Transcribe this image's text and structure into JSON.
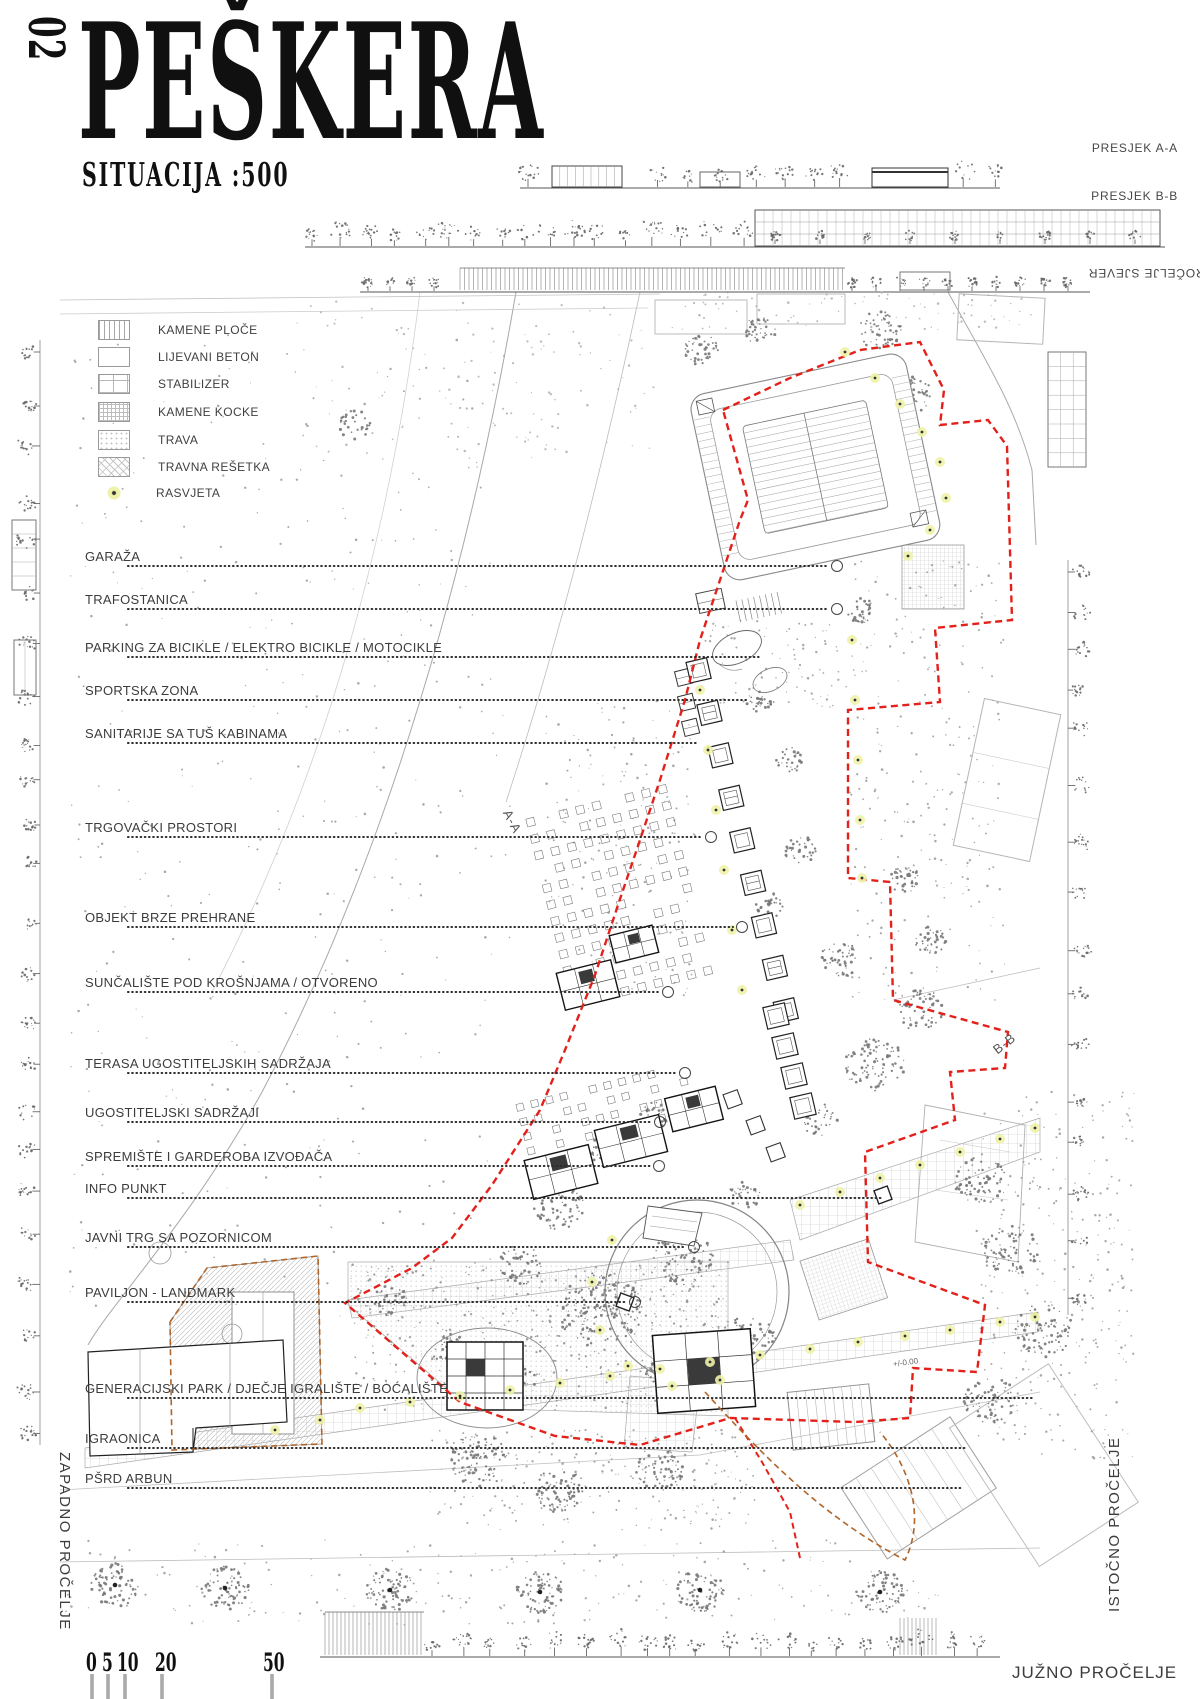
{
  "title_block": {
    "number": "02",
    "title": "PEŠKERA",
    "subtitle": "SITUACIJA :500"
  },
  "section_labels": {
    "presjek_aa": "PRESJEK A-A",
    "presjek_bb": "PRESJEK B-B",
    "procelje_sjever": "PROČELJE SJEVER",
    "juzno_procelje": "JUŽNO PROČELJE",
    "zapadno_procelje": "ZAPADNO PROČELJE",
    "istocno_procelje": "ISTOČNO PROČELJE"
  },
  "section_marks": {
    "aa": "A-A",
    "bb": "B-B"
  },
  "legend": [
    {
      "label": "KAMENE PLOČE",
      "swatch": "vlines"
    },
    {
      "label": "LIJEVANI BETON",
      "swatch": "plain"
    },
    {
      "label": "STABILIZER",
      "swatch": "coarse-grid"
    },
    {
      "label": "KAMENE KOCKE",
      "swatch": "fine-grid"
    },
    {
      "label": "TRAVA",
      "swatch": "dots"
    },
    {
      "label": "TRAVNA REŠETKA",
      "swatch": "diagonal"
    },
    {
      "label": "RASVJETA",
      "swatch": "light"
    }
  ],
  "plan_labels": [
    {
      "label": "GARAŽA",
      "y": 549,
      "to": 828,
      "end": "circle"
    },
    {
      "label": "TRAFOSTANICA",
      "y": 592,
      "to": 828,
      "end": "circle"
    },
    {
      "label": "PARKING ZA BICIKLE / ELEKTRO BICIKLE / MOTOCIKLE",
      "y": 640,
      "to": 762,
      "end": "none"
    },
    {
      "label": "SPORTSKA ZONA",
      "y": 683,
      "to": 746,
      "end": "none"
    },
    {
      "label": "SANITARIJE SA TUŠ KABINAMA",
      "y": 726,
      "to": 697,
      "end": "none"
    },
    {
      "label": "TRGOVAČKI PROSTORI",
      "y": 820,
      "to": 702,
      "end": "circle"
    },
    {
      "label": "OBJEKT BRZE PREHRANE",
      "y": 910,
      "to": 733,
      "end": "circle"
    },
    {
      "label": "SUNČALIŠTE POD KROŠNJAMA / OTVORENO",
      "y": 975,
      "to": 659,
      "end": "circle"
    },
    {
      "label": "TERASA UGOSTITELJSKIH SADRŽAJA",
      "y": 1056,
      "to": 676,
      "end": "circle"
    },
    {
      "label": "UGOSTITELJSKI SADRŽAJI",
      "y": 1105,
      "to": 651,
      "end": "circle"
    },
    {
      "label": "SPREMIŠTE I GARDEROBA IZVOĐAČA",
      "y": 1149,
      "to": 650,
      "end": "circle"
    },
    {
      "label": "INFO PUNKT",
      "y": 1181,
      "to": 883,
      "end": "none"
    },
    {
      "label": "JAVNI TRG SA POZORNICOM",
      "y": 1230,
      "to": 685,
      "end": "circle"
    },
    {
      "label": "PAVILJON - LANDMARK",
      "y": 1285,
      "to": 626,
      "end": "circle"
    },
    {
      "label": "GENERACIJSKI PARK / DJEČJE IGRALIŠTE / BOĆALIŠTE",
      "y": 1381,
      "to": 1035,
      "end": "none"
    },
    {
      "label": "IGRAONICA",
      "y": 1431,
      "to": 965,
      "end": "none"
    },
    {
      "label": "PŠRD ARBUN",
      "y": 1471,
      "to": 962,
      "end": "none"
    }
  ],
  "scale_bar": {
    "values": [
      "0",
      "5",
      "10",
      "20",
      "50"
    ]
  },
  "annotations": {
    "level": "+/-0.00"
  },
  "colors": {
    "boundary": "#e3211a",
    "secondary_boundary": "#b06428",
    "lighting": "#eef2a8",
    "linework": "#8c8c8c"
  }
}
